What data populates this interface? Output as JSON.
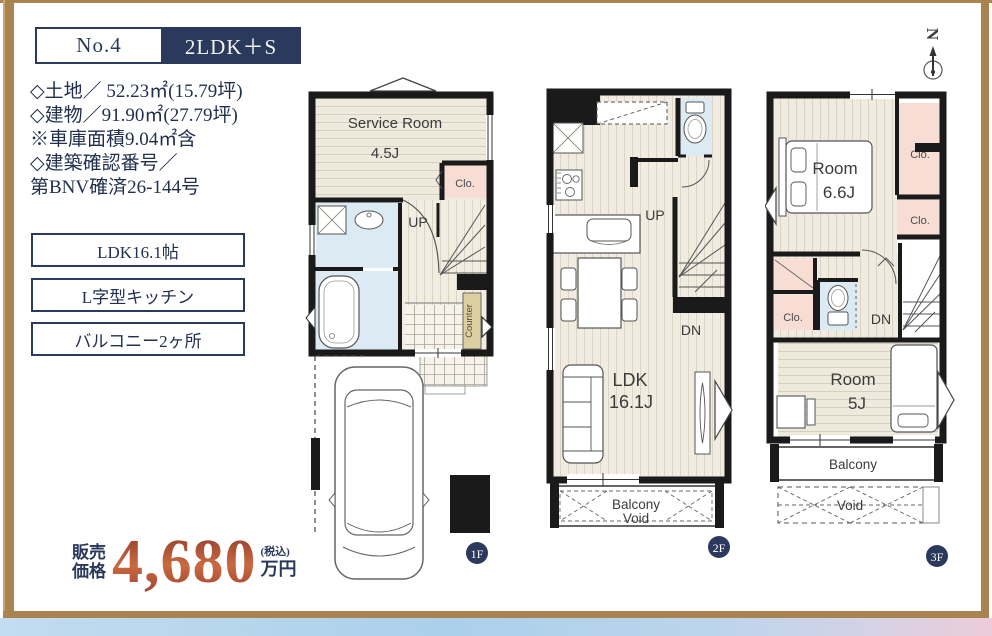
{
  "header": {
    "number": "No.4",
    "layout": "2LDK＋S"
  },
  "details": {
    "lines": [
      "◇土地／ 52.23㎡(15.79坪)",
      "◇建物／91.90㎡(27.79坪)",
      "※車庫面積9.04㎡含",
      "◇建築確認番号／",
      "第BNV確済26-144号"
    ]
  },
  "features": {
    "items": [
      "LDK16.1帖",
      "L字型キッチン",
      "バルコニー2ヶ所"
    ]
  },
  "price": {
    "label_line1": "販売",
    "label_line2": "価格",
    "amount": "4,680",
    "tax_note": "(税込)",
    "unit": "万円"
  },
  "compass": {
    "north": "N"
  },
  "floor1": {
    "badge": "1F",
    "service_room": "Service Room",
    "service_room_size": "4.5J",
    "closet": "Clo.",
    "up": "UP",
    "counter": "Counter"
  },
  "floor2": {
    "badge": "2F",
    "up": "UP",
    "dn": "DN",
    "ldk": "LDK",
    "ldk_size": "16.1J",
    "balcony": "Balcony",
    "void": "Void"
  },
  "floor3": {
    "badge": "3F",
    "room_main": "Room",
    "room_main_size": "6.6J",
    "room_sub": "Room",
    "room_sub_size": "5J",
    "closet1": "Clo.",
    "closet2": "Clo.",
    "closet3": "Clo.",
    "dn": "DN",
    "balcony": "Balcony",
    "void": "Void"
  },
  "colors": {
    "navy": "#2b3a5c",
    "gold_frame": "#a98350",
    "price_red": "#ab4b35",
    "closet_pink": "#f8ddd5",
    "water_blue": "#dcebf3",
    "counter_tan": "#ddd0a0",
    "wall_black": "#1a1a1a"
  }
}
